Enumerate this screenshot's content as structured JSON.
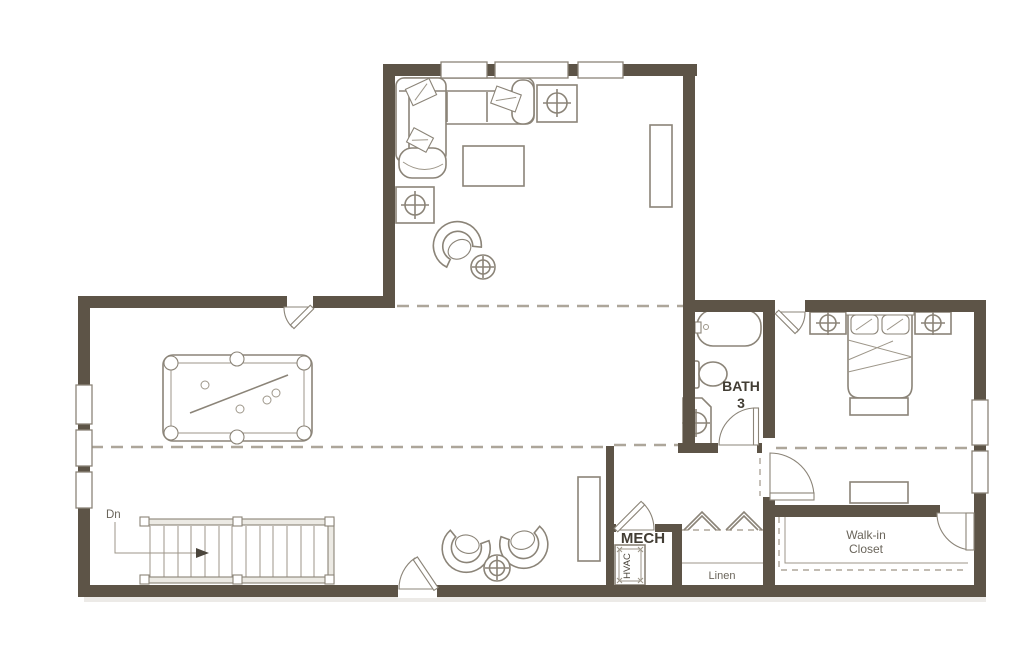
{
  "document": {
    "type": "floor-plan",
    "background": "#ffffff"
  },
  "colors": {
    "wall": "#5d5447",
    "furniture_line": "#8b8478",
    "dashed_break_line": "#ada69a",
    "text": "#4b453c",
    "bold_text": "#423d34"
  },
  "labels": {
    "stairs_direction": "Dn",
    "bath": {
      "line1": "BATH",
      "line2": "3"
    },
    "mech": "MECH",
    "hvac": "HVAC",
    "linen": "Linen",
    "walk_in_closet": {
      "line1": "Walk-in",
      "line2": "Closet"
    }
  },
  "fixtures": [
    "sectional-sofa",
    "coffee-table",
    "end-table-lamp",
    "media-console",
    "swivel-chair",
    "round-side-table",
    "pool-table",
    "staircase-down",
    "barrel-chair",
    "tall-cabinet",
    "bathtub",
    "toilet",
    "sink-vanity",
    "bed",
    "nightstand-lamp",
    "bench",
    "dresser",
    "hvac-unit",
    "bifold-door",
    "door-swing",
    "window"
  ]
}
